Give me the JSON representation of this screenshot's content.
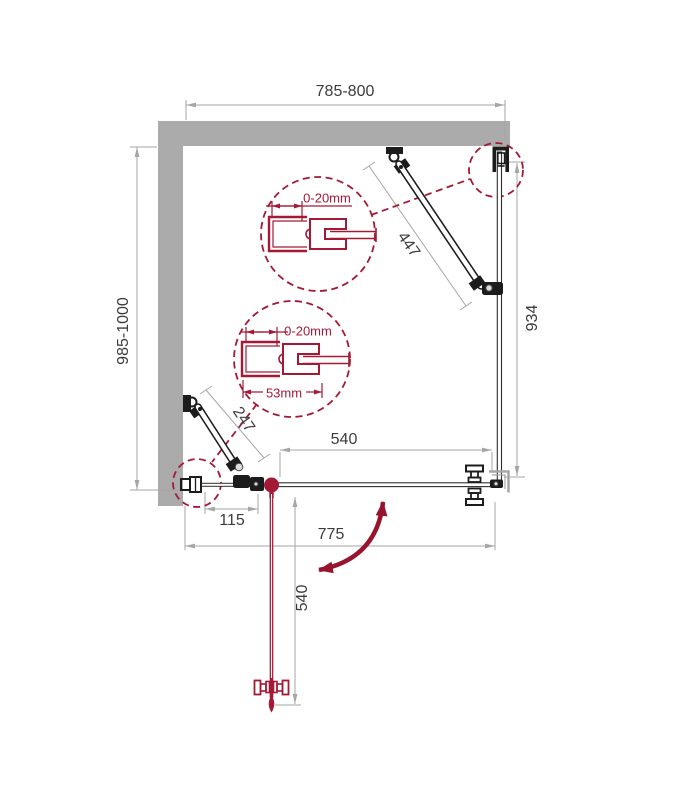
{
  "diagram": {
    "type": "shower-enclosure-plan-drawing",
    "dims": {
      "width": "785-800",
      "depth": "985-1000",
      "bar_right": "447",
      "bar_left": "247",
      "side_panel": "934",
      "door_width": "540",
      "hinge_offset": "115",
      "front_width": "775",
      "door_open": "540",
      "gap_top": "0-20mm",
      "gap_bottom": "0-20mm",
      "profile_width": "53mm"
    },
    "colors": {
      "accent": "#A41A36",
      "accent_dark": "#98142E",
      "wall": "#ABABAB",
      "dim_line": "#A6A6A6",
      "dim_text": "#3C3C3C",
      "hardware": "#1C1C1C"
    }
  }
}
